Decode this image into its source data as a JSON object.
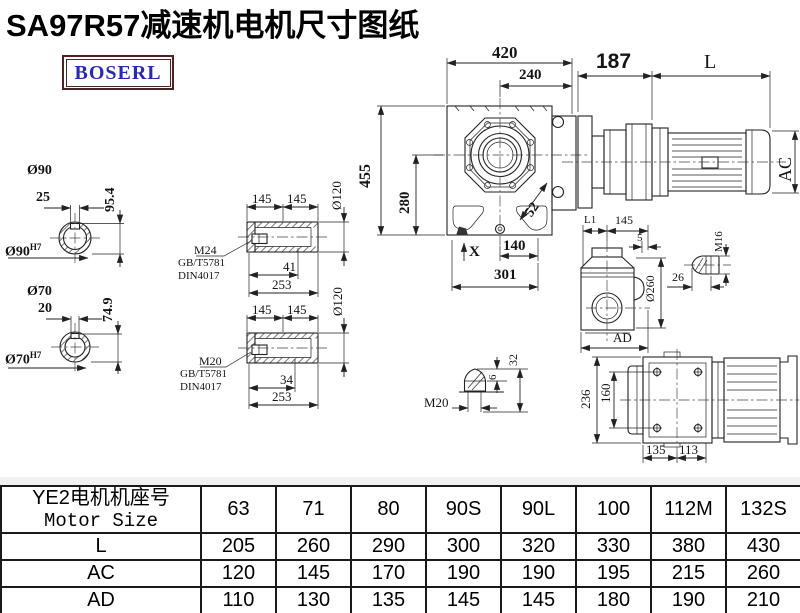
{
  "title": "SA97R57减速机电机尺寸图纸",
  "logo": {
    "text": "BOSERL",
    "border_color": "#4a2323",
    "text_color": "#2a2ab0"
  },
  "views": {
    "hollow_shaft_90": {
      "diameter": "Ø90",
      "keyway_width": "25",
      "keyway_height": "95.4",
      "bore": "Ø90",
      "tolerance": "H7"
    },
    "hollow_shaft_70": {
      "diameter": "Ø70",
      "keyway_width": "20",
      "keyway_height": "74.9",
      "bore": "Ø70",
      "tolerance": "H7"
    },
    "bushing_m24": {
      "len1": "145",
      "len2": "145",
      "outer_dia": "Ø120",
      "thread": "M24",
      "standard1": "GB/T5781",
      "standard2": "DIN4017",
      "thread_depth": "41",
      "total_len": "253"
    },
    "bushing_m20": {
      "len1": "145",
      "len2": "145",
      "outer_dia": "Ø120",
      "thread": "M20",
      "standard1": "GB/T5781",
      "standard2": "DIN4017",
      "thread_depth": "34",
      "total_len": "253"
    },
    "front_view": {
      "width": "420",
      "inner_width": "240",
      "height": "455",
      "center_height": "280",
      "bolt_dim": "52",
      "foot": "140",
      "base": "301",
      "mark": "X"
    },
    "motor_view": {
      "adapter": "187",
      "length": "L",
      "diameter": "AC"
    },
    "side_view": {
      "dim_l1": "L1",
      "width": "145",
      "offset": "5",
      "flange_dia": "Ø260",
      "width_label": "AD"
    },
    "bolt_m16": {
      "thread": "M16",
      "length": "26"
    },
    "bolt_m20": {
      "thread": "M20",
      "dim_6": "6",
      "dim_32": "32"
    },
    "rear_view": {
      "height": "236",
      "bolt_spacing": "160",
      "w1": "135",
      "w2": "113"
    }
  },
  "table": {
    "header_cn": "YE2电机机座号",
    "header_en": "Motor Size",
    "columns": [
      "63",
      "71",
      "80",
      "90S",
      "90L",
      "100",
      "112M",
      "132S"
    ],
    "rows": [
      {
        "label": "L",
        "values": [
          "205",
          "260",
          "290",
          "300",
          "320",
          "330",
          "380",
          "430"
        ]
      },
      {
        "label": "AC",
        "values": [
          "120",
          "145",
          "170",
          "190",
          "190",
          "195",
          "215",
          "260"
        ]
      },
      {
        "label": "AD",
        "values": [
          "110",
          "130",
          "135",
          "145",
          "145",
          "180",
          "190",
          "210"
        ]
      }
    ]
  }
}
